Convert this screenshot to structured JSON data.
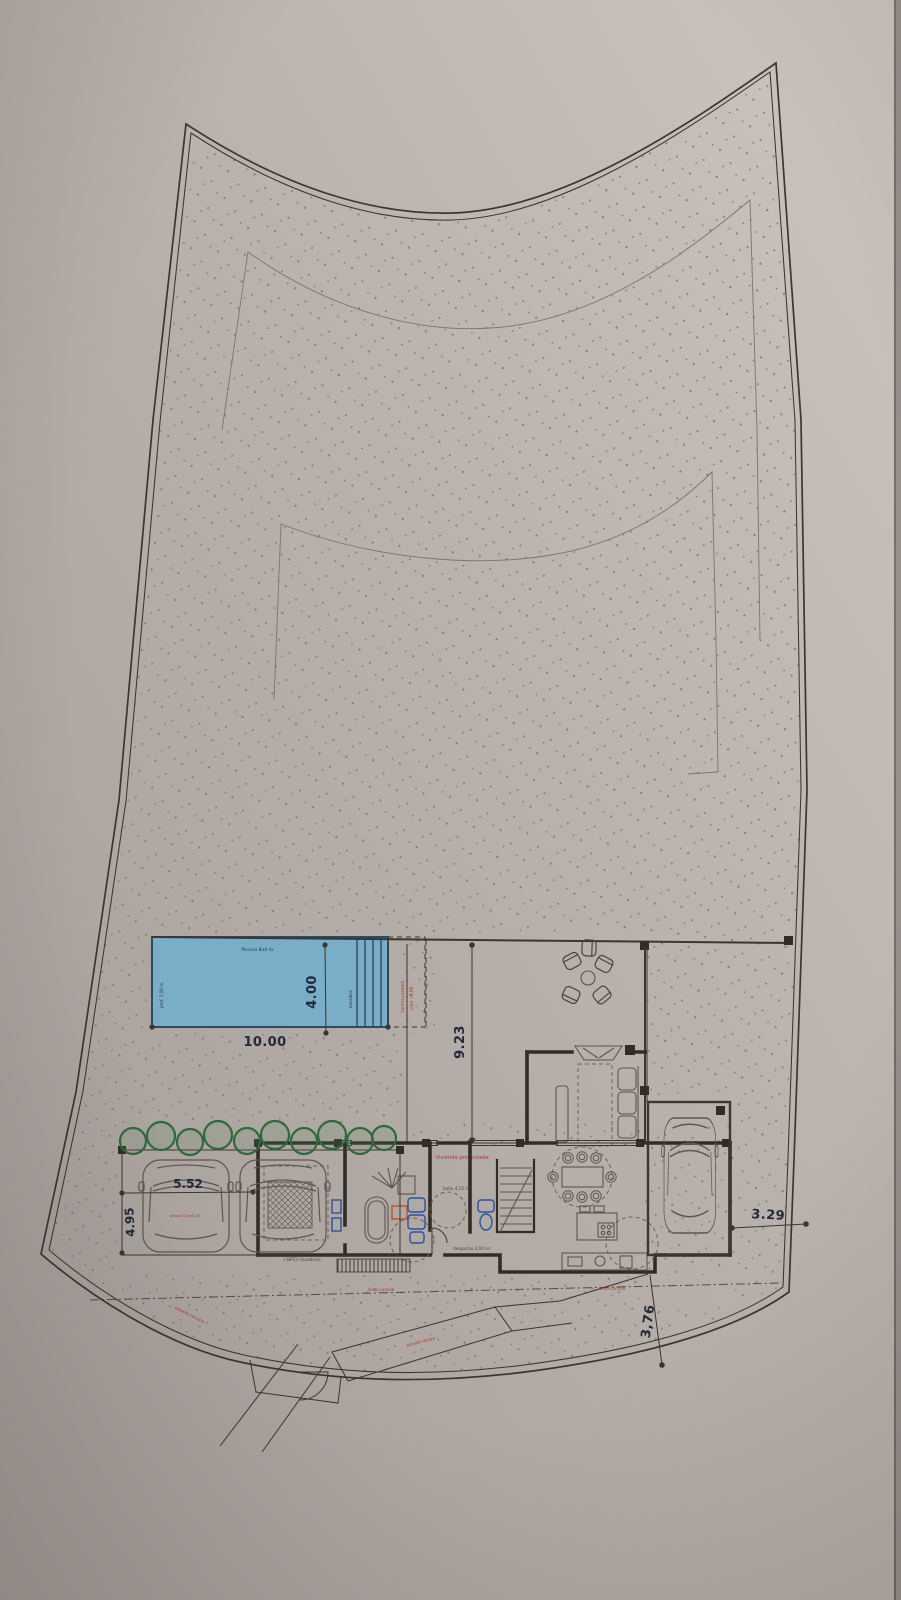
{
  "meta": {
    "title": "Plano de emplazamiento - planta vivienda"
  },
  "dims": {
    "pool_length": "10.00",
    "pool_width": "4.00",
    "terrace_depth": "9.23",
    "parking_width": "5.52",
    "parking_depth": "4.95",
    "side_setback": "3.29",
    "front_setback": "3,76"
  },
  "labels": {
    "pool_title": "Piscina 8x4 m.",
    "pool_depth": "prof. 1,50 m",
    "pool_steps": "escalera",
    "solarium_a": "tarima madera",
    "solarium_b": "cota +0,00",
    "house": "Vivienda proyectada",
    "cornice": "línea cornisa",
    "ramp": "acceso rampa",
    "grade": "rasante terreno",
    "parking_slot": "plaza 2,50x5,00",
    "room_laundry": "s.NP53 (lavadero)",
    "room_bath": "baño 4,15 m²",
    "room_office": "despacho 4,04 m²"
  },
  "colors": {
    "paper_light": "#cac2bb",
    "paper_mid": "#b7afa9",
    "paper_dark": "#a29a95",
    "ink": "#3c362f",
    "wall": "#322c26",
    "pool_fill": "#7aadc7",
    "pool_line": "#2a4a66",
    "dim": "#23283a",
    "red": "#ac3a2c",
    "blue_fixture": "#2a52a0",
    "green": "#2e6a3b",
    "orange": "#c0542f",
    "stipple": "#857c75"
  }
}
